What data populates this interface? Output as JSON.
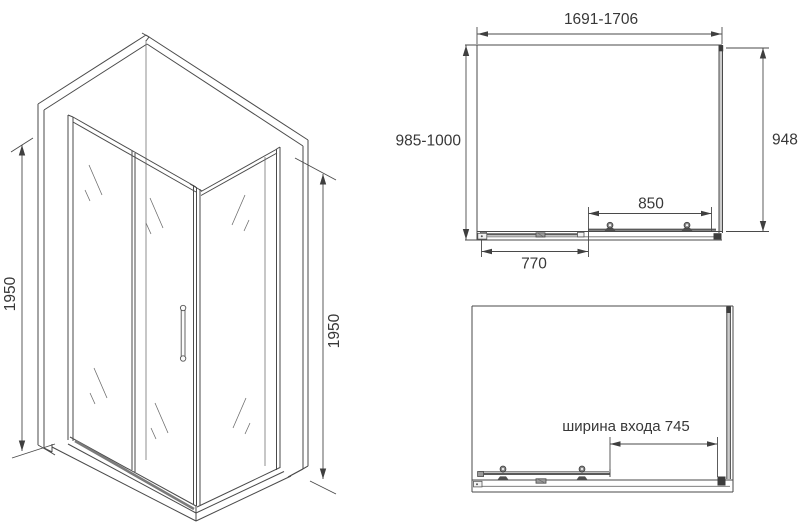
{
  "page": {
    "background": "#ffffff",
    "line_color": "#4a4a4a",
    "text_color": "#383838"
  },
  "iso_view": {
    "dimensions": {
      "left_height": "1950",
      "right_height": "1950"
    }
  },
  "top_view_closed": {
    "dimensions": {
      "overall_width": "1691-1706",
      "overall_depth": "985-1000",
      "side_panel": "948",
      "door_span": "850",
      "fixed_panel": "770"
    }
  },
  "top_view_open": {
    "dimensions": {
      "entry_width": "ширина входа 745"
    }
  }
}
